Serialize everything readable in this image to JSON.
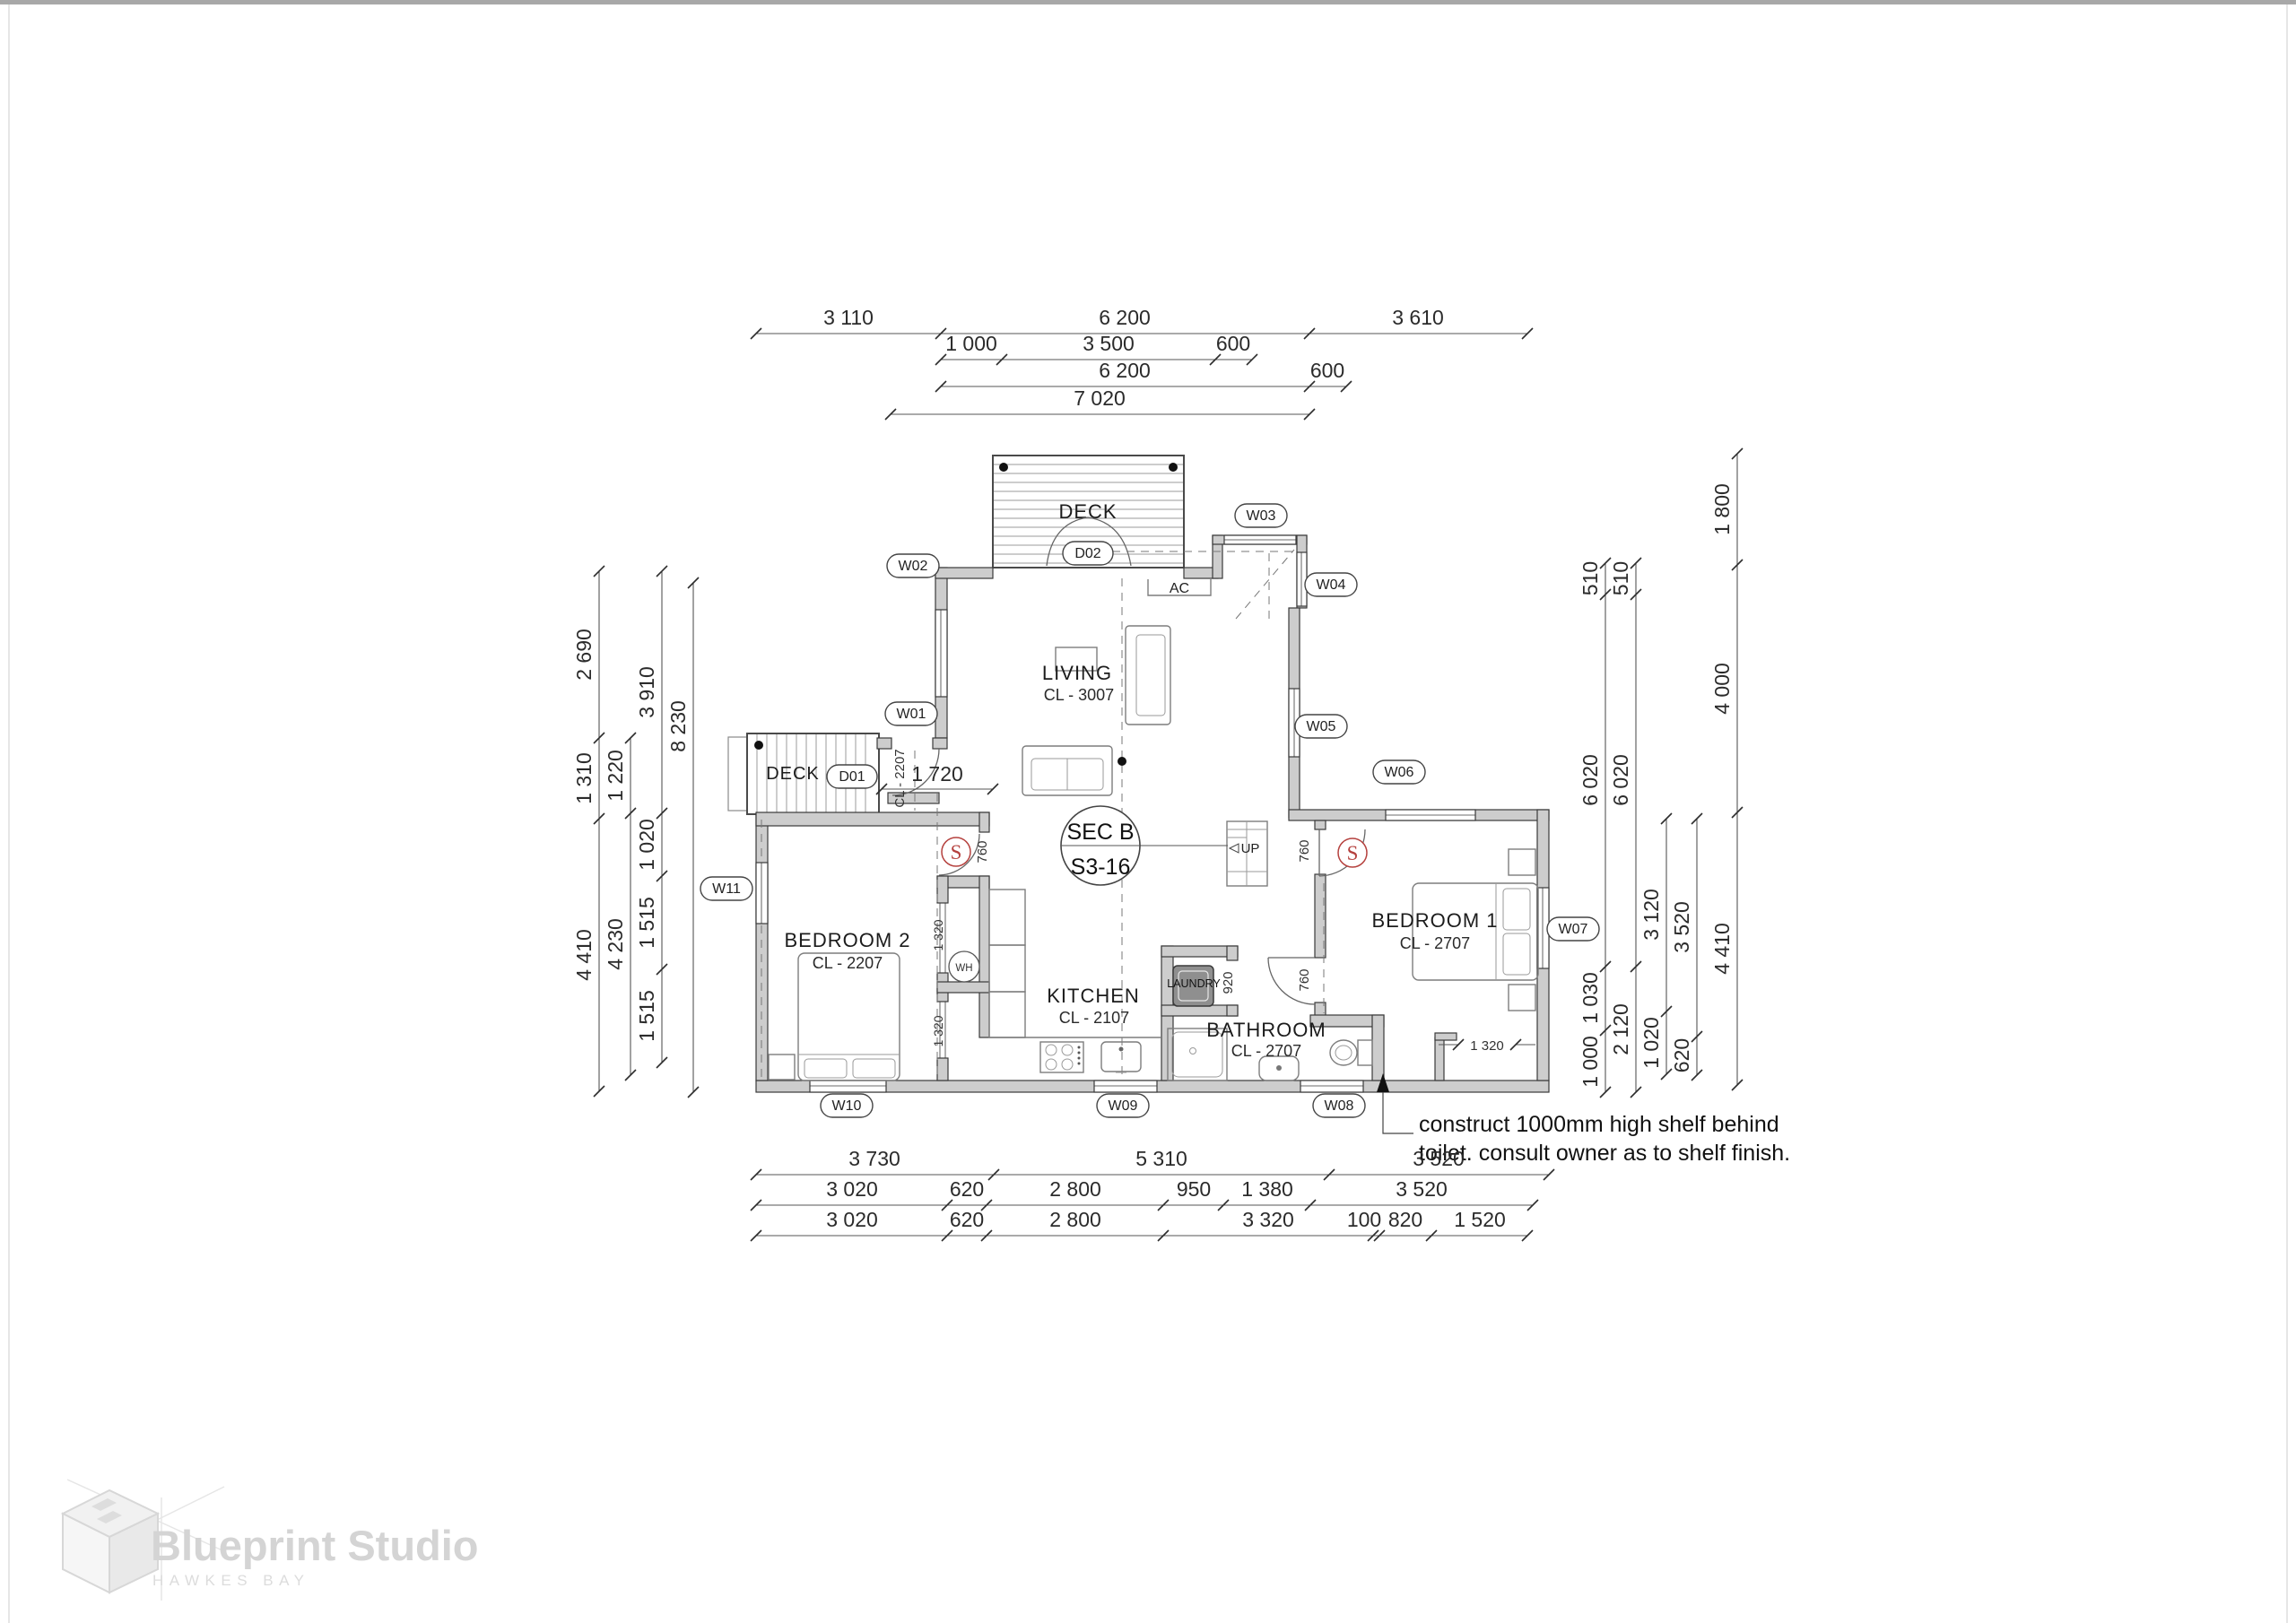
{
  "drawing": {
    "rooms": {
      "living": {
        "name": "LIVING",
        "ceiling": "CL - 3007"
      },
      "kitchen": {
        "name": "KITCHEN",
        "ceiling": "CL - 2107"
      },
      "bathroom": {
        "name": "BATHROOM",
        "ceiling": "CL - 2707"
      },
      "bedroom1": {
        "name": "BEDROOM 1",
        "ceiling": "CL - 2707"
      },
      "bedroom2": {
        "name": "BEDROOM 2",
        "ceiling": "CL - 2207"
      },
      "laundry": {
        "name": "LAUNDRY"
      },
      "deck_north": {
        "name": "DECK"
      },
      "deck_west": {
        "name": "DECK"
      }
    },
    "tags": {
      "w01": "W01",
      "w02": "W02",
      "w03": "W03",
      "w04": "W04",
      "w05": "W05",
      "w06": "W06",
      "w07": "W07",
      "w08": "W08",
      "w09": "W09",
      "w10": "W10",
      "w11": "W11",
      "d01": "D01",
      "d02": "D02"
    },
    "annotations": {
      "section_ref_top": "SEC B",
      "section_ref_bottom": "S3-16",
      "stair_direction": "UP",
      "air_conditioner": "AC",
      "water_heater": "WH",
      "smoke_alarm": "S",
      "entry_ceiling": "CL - 2207",
      "note_line1": "construct 1000mm high shelf behind",
      "note_line2": "toilet. consult owner as to shelf finish."
    },
    "inline_dims": {
      "entry_width": "1 720",
      "bedroom2_door": "760",
      "bedroom1_door": "760",
      "bathroom_door": "760",
      "laundry_door": "920",
      "closet_upper": "1 320",
      "closet_lower": "1 320",
      "wardrobe": "1 320"
    },
    "dim_chains": {
      "top": [
        [
          "3 110",
          "6 200",
          "3 610"
        ],
        [
          "1 000",
          "3 500",
          "600"
        ],
        [
          "6 200",
          "600"
        ],
        [
          "7 020"
        ]
      ],
      "left": [
        [
          "2 690",
          "1 310",
          "4 410"
        ],
        [
          "1 220",
          "4 230"
        ],
        [
          "3 910",
          "1 020",
          "1 515",
          "1 515"
        ],
        [
          "8 230"
        ]
      ],
      "right": [
        [
          "510",
          "6 020",
          "1 030",
          "1 000"
        ],
        [
          "510",
          "6 020",
          "2 120"
        ],
        [
          "3 120",
          "1 020"
        ],
        [
          "3 520",
          "620"
        ],
        [
          "1 800",
          "4 000",
          "4 410"
        ]
      ],
      "bottom": [
        [
          "3 730",
          "5 310",
          "3 520"
        ],
        [
          "3 020",
          "620",
          "2 800",
          "950",
          "1 380",
          "3 520"
        ],
        [
          "3 020",
          "620",
          "2 800",
          "3 320",
          "100",
          "820",
          "1 520"
        ]
      ]
    }
  },
  "logo": {
    "studio": "Blueprint Studio",
    "location": "HAWKES BAY"
  },
  "colors": {
    "smoke_alarm_red": "#b5413e",
    "wall_fill": "#cdcdcd",
    "logo_gray": "#d4d4d4"
  }
}
